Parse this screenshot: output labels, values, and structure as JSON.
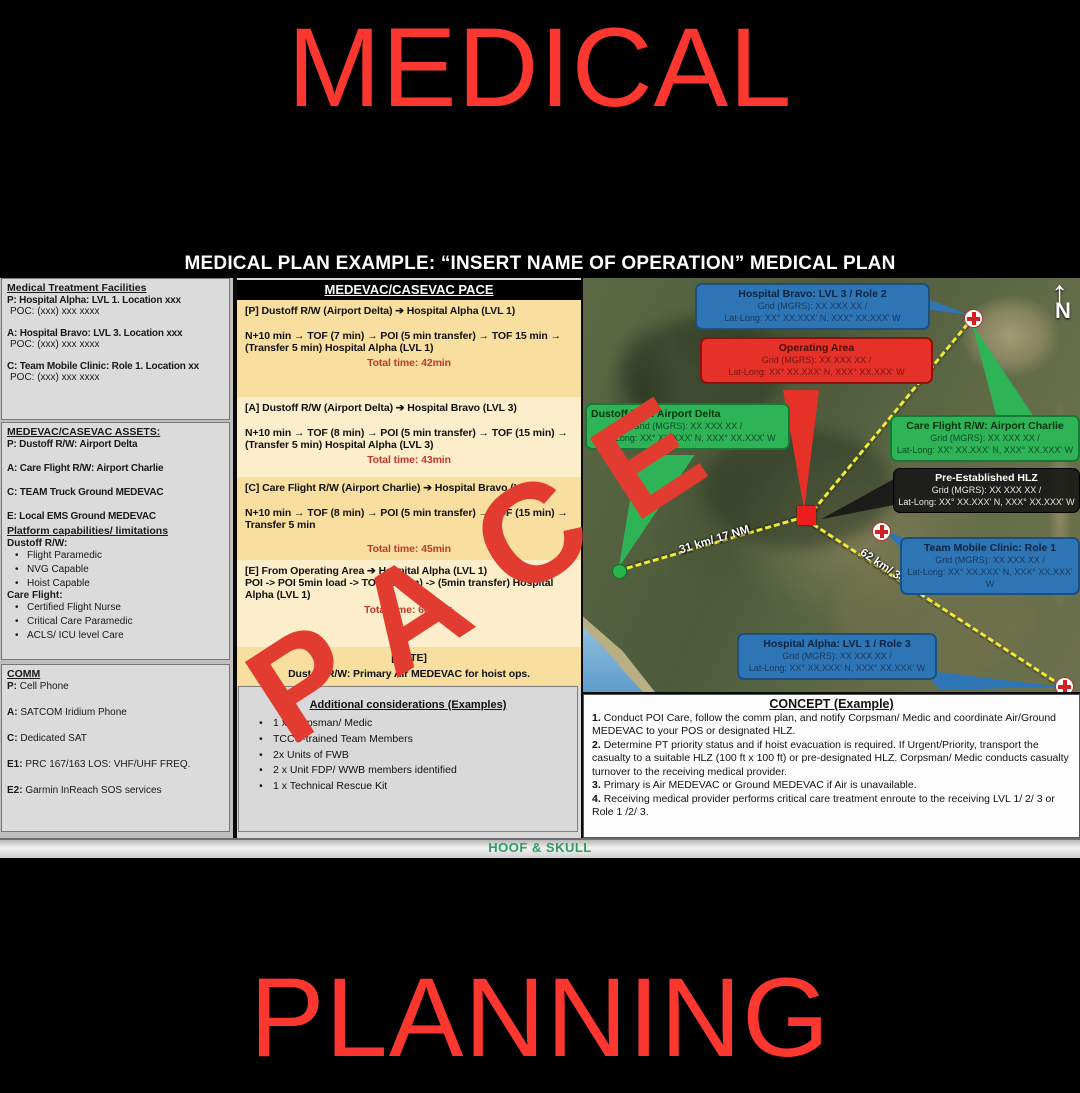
{
  "page": {
    "top_title": "MEDICAL",
    "bottom_title": "PLANNING",
    "watermark": "PACE",
    "footer": "HOOF & SKULL",
    "slide_title": "MEDICAL PLAN EXAMPLE: “INSERT NAME OF OPERATION” MEDICAL PLAN"
  },
  "left_panel": {
    "mtf": {
      "heading": "Medical Treatment Facilities",
      "entries": [
        {
          "line": "P: Hospital Alpha: LVL 1. Location xxx",
          "poc": "POC: (xxx) xxx xxxx"
        },
        {
          "line": "A: Hospital Bravo: LVL 3. Location xxx",
          "poc": "POC: (xxx) xxx xxxx"
        },
        {
          "line": "C: Team Mobile Clinic: Role 1.  Location xx",
          "poc": "POC: (xxx) xxx xxxx"
        }
      ]
    },
    "assets": {
      "heading": "MEDEVAC/CASEVAC ASSETS:",
      "items": [
        "P: Dustoff R/W: Airport Delta",
        "A: Care Flight R/W: Airport Charlie",
        "C:  TEAM Truck Ground MEDEVAC",
        "E: Local EMS Ground MEDEVAC"
      ]
    },
    "platform": {
      "heading": "Platform capabilities/ limitations",
      "groups": [
        {
          "title": "Dustoff R/W:",
          "items": [
            "Flight Paramedic",
            "NVG Capable",
            "Hoist Capable"
          ]
        },
        {
          "title": "Care Flight:",
          "items": [
            "Certified Flight Nurse",
            "Critical Care Paramedic",
            "ACLS/ ICU level Care"
          ]
        }
      ]
    },
    "comm": {
      "heading": "COMM",
      "items": [
        {
          "label": "P:",
          "text": "Cell Phone"
        },
        {
          "label": "A:",
          "text": "SATCOM Iridium Phone"
        },
        {
          "label": "C:",
          "text": "Dedicated SAT"
        },
        {
          "label": "E1:",
          "text": "PRC 167/163 LOS: VHF/UHF FREQ."
        },
        {
          "label": "E2:",
          "text": "Garmin InReach SOS services"
        }
      ]
    }
  },
  "pace_panel": {
    "header": "MEDEVAC/CASEVAC PACE",
    "blocks": [
      {
        "title": "[P] Dustoff R/W (Airport Delta) ➔ Hospital Alpha (LVL 1)",
        "detail": "N+10 min → TOF (7 min) → POI (5 min transfer) → TOF 15 min → (Transfer 5 min) Hospital Alpha (LVL 1)",
        "total": "Total time: 42min"
      },
      {
        "title": "[A] Dustoff R/W (Airport Delta) ➔ Hospital Bravo (LVL 3)",
        "detail": "N+10 min → TOF (8 min) → POI (5 min transfer) → TOF (15 min) → (Transfer 5 min) Hospital Alpha (LVL 3)",
        "total": "Total time: 43min"
      },
      {
        "title": "[C] Care Flight R/W (Airport Charlie) ➔ Hospital Bravo (LVL 3)",
        "detail": "N+10 min → TOF (8 min) → POI (5 min transfer) → TOF (15 min) → Transfer 5 min",
        "total": "Total time: 45min"
      },
      {
        "title": "[E] From Operating Area ➔ Hospital Alpha (LVL 1)",
        "detail": "POI -> POI 5min load -> TOD (50min) -> (5min transfer) Hospital Alpha (LVL 1)",
        "total": "Total time: 60min+"
      }
    ],
    "note_label": "[NOTE]",
    "note_text": "Dustoff R/W: Primary Air MEDEVAC for hoist ops.",
    "additional": {
      "heading": "Additional considerations (Examples)",
      "items": [
        "1 x Corpsman/ Medic",
        "TCCC-trained Team Members",
        "2x Units of FWB",
        "2 x Unit FDP/ WWB members identified",
        "1 x Technical Rescue Kit"
      ]
    }
  },
  "map": {
    "north_label": "N",
    "distances": {
      "d1": "31 km/ 17 NM",
      "d2": "62 km/ 34 NM"
    },
    "callouts": {
      "hospital_bravo": {
        "title": "Hospital Bravo: LVL 3 / Role 2",
        "grid": "Grid (MGRS): XX XXX XX /",
        "latlong": "Lat-Long: XX° XX.XXX' N, XXX° XX.XXX' W"
      },
      "operating_area": {
        "title": "Operating Area",
        "grid": "Grid (MGRS): XX XXX XX /",
        "latlong": "Lat-Long: XX° XX.XXX' N, XXX° XX.XXX' W"
      },
      "dustoff": {
        "title": "Dustoff R/W: Airport Delta",
        "grid": "Grid (MGRS): XX XXX XX /",
        "latlong": "Lat-Long: XX° XX.XXX' N, XXX° XX.XXX' W"
      },
      "care_flight": {
        "title": "Care Flight  R/W: Airport Charlie",
        "grid": "Grid (MGRS): XX XXX XX /",
        "latlong": "Lat-Long: XX° XX.XXX' N, XXX° XX.XXX' W"
      },
      "hlz": {
        "title": "Pre-Established HLZ",
        "grid": "Grid (MGRS): XX XXX XX /",
        "latlong": "Lat-Long: XX° XX.XXX' N, XXX° XX.XXX' W"
      },
      "team_clinic": {
        "title": "Team Mobile Clinic: Role 1",
        "grid": "Grid (MGRS): XX XXX XX /",
        "latlong": "Lat-Long: XX° XX.XXX' N, XXX° XX.XXX' W"
      },
      "hospital_alpha": {
        "title": "Hospital Alpha: LVL 1 / Role 3",
        "grid": "Grid (MGRS): XX XXX XX /",
        "latlong": "Lat-Long: XX° XX.XXX' N, XXX° XX.XXX' W"
      }
    }
  },
  "concept": {
    "heading": "CONCEPT (Example)",
    "items": [
      {
        "num": "1.",
        "text": "Conduct POI Care, follow the comm plan, and notify Corpsman/ Medic and coordinate Air/Ground MEDEVAC to your POS or designated HLZ."
      },
      {
        "num": "2.",
        "text": "Determine PT priority status and if hoist evacuation is required. If Urgent/Priority, transport the casualty to a suitable HLZ (100 ft x 100 ft) or pre-designated HLZ. Corpsman/ Medic conducts casualty turnover to the receiving medical provider."
      },
      {
        "num": "3.",
        "text": "Primary is Air MEDEVAC or Ground MEDEVAC if Air is unavailable."
      },
      {
        "num": "4.",
        "text": "Receiving medical provider performs critical care treatment enroute to the receiving LVL 1/ 2/ 3  or Role 1 /2/ 3."
      }
    ]
  },
  "colors": {
    "accent_red": "#fb372f",
    "watermark_red": "#e23c30",
    "total_time_red": "#c0392b",
    "callout_blue": "#2e75b6",
    "callout_green": "#2fb357",
    "callout_red": "#e63128",
    "footer_green": "#2f9e5f",
    "pace_dark_yellow": "#f8dfa0",
    "pace_light_yellow": "#fceecb"
  }
}
